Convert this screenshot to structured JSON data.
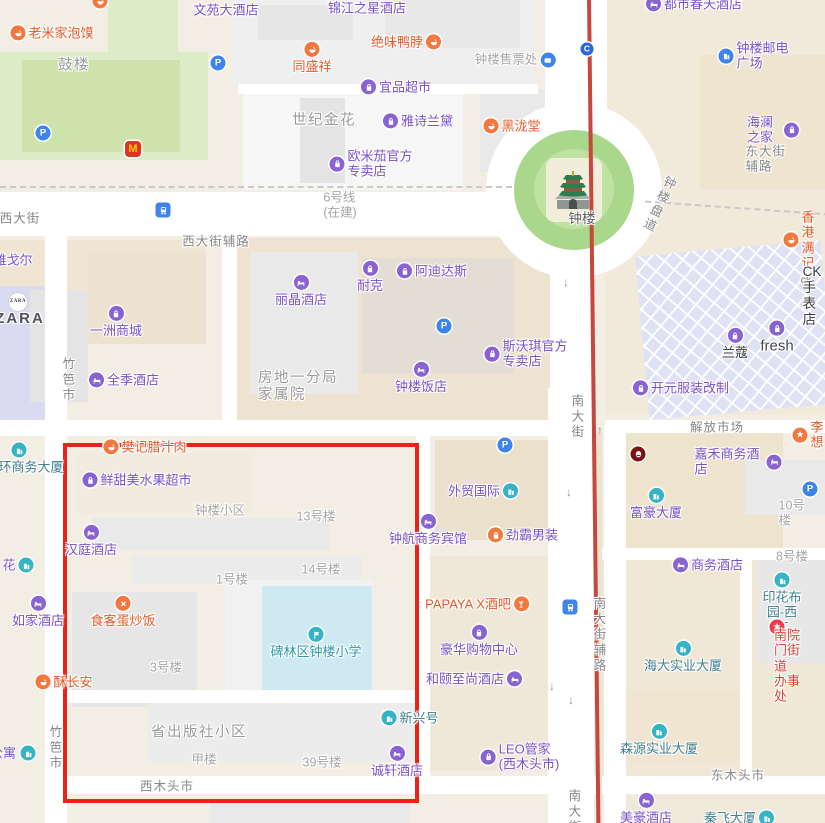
{
  "map": {
    "colors": {
      "poi_purple": "#7a52c8",
      "poi_orange": "#e25a28",
      "building_teal": "#41808f",
      "street_gray": "#878787",
      "block_gray": "#a6a6a6",
      "metro_line_red": "#c7463e",
      "highlight_red": "#e8231a",
      "parking_blue": "#3f84ee",
      "park_green": "#a9d88d"
    },
    "icons": {
      "parking": "P",
      "line_badge": "C",
      "mcdonalds": "M",
      "star": "★"
    },
    "pois": [
      {
        "l": "文苑大酒店",
        "x": 226,
        "y": 10,
        "k": "purple"
      },
      {
        "l": "",
        "x": 100,
        "y": 1,
        "k": "orange",
        "i": "food",
        "c": "orange"
      },
      {
        "l": "锦江之星酒店",
        "x": 367,
        "y": 8,
        "k": "purple"
      },
      {
        "l": "老米家泡馍",
        "x": 52,
        "y": 33,
        "k": "orange",
        "i": "food",
        "c": "orange"
      },
      {
        "l": "鼓楼",
        "x": 74,
        "y": 66,
        "k": "biggray"
      },
      {
        "l": "绝味鸭脖",
        "x": 406,
        "y": 42,
        "k": "orange",
        "i": "food",
        "c": "orange",
        "p": "right"
      },
      {
        "l": "同盛祥",
        "x": 312,
        "y": 58,
        "k": "orange",
        "i": "food",
        "c": "orange",
        "p": "above"
      },
      {
        "l": "钟楼售票处",
        "x": 515,
        "y": 60,
        "k": "gray",
        "i": "ticket",
        "c": "blue",
        "p": "right"
      },
      {
        "l": "都市春天酒店",
        "x": 694,
        "y": 4,
        "k": "purple",
        "i": "hotel",
        "c": "purple"
      },
      {
        "l": "",
        "x": 587,
        "y": 49,
        "k": "purple",
        "i": "c",
        "c": "cblue",
        "n": "metro-line-badge"
      },
      {
        "l": "钟楼邮电广场",
        "x": 754,
        "y": 56,
        "k": "purple",
        "i": "building",
        "c": "blue"
      },
      {
        "l": "",
        "x": 218,
        "y": 63,
        "k": "purple",
        "i": "p",
        "c": "blue",
        "n": "parking-icon"
      },
      {
        "l": "海澜之家",
        "x": 773,
        "y": 130,
        "k": "purple",
        "i": "bag",
        "c": "purple",
        "p": "right"
      },
      {
        "l": "宜品超市",
        "x": 396,
        "y": 87,
        "k": "purple",
        "i": "bag",
        "c": "purple"
      },
      {
        "l": "世纪金花",
        "x": 324,
        "y": 121,
        "k": "biggray"
      },
      {
        "l": "雅诗兰黛",
        "x": 418,
        "y": 121,
        "k": "purple",
        "i": "bag",
        "c": "purple"
      },
      {
        "l": "黑泷堂",
        "x": 512,
        "y": 126,
        "k": "orange",
        "i": "food",
        "c": "orange"
      },
      {
        "l": "东大街辅路",
        "x": 772,
        "y": 159,
        "k": "street"
      },
      {
        "l": "",
        "x": 43,
        "y": 133,
        "k": "purple",
        "i": "p",
        "c": "blue",
        "n": "parking-icon"
      },
      {
        "l": "",
        "x": 133,
        "y": 149,
        "k": "orange",
        "i": "m",
        "c": "mcd",
        "n": "mcdonalds-icon"
      },
      {
        "l": "欧米茄官方\n专卖店",
        "x": 371,
        "y": 164,
        "k": "purple",
        "i": "bag",
        "c": "purple"
      },
      {
        "l": "",
        "x": 573,
        "y": 190,
        "k": "purple",
        "i": "pagoda",
        "c": "none",
        "n": "bell-tower-icon"
      },
      {
        "l": "钟楼",
        "x": 582,
        "y": 219,
        "k": "tower"
      },
      {
        "l": "钟楼盘道",
        "x": 658,
        "y": 204,
        "k": "street",
        "v": true,
        "r": 25
      },
      {
        "l": "东大街",
        "x": 841,
        "y": 181,
        "k": "street"
      },
      {
        "l": "6号线\n(在建)",
        "x": 340,
        "y": 205,
        "k": "gray"
      },
      {
        "l": "西大街",
        "x": 20,
        "y": 219,
        "k": "street"
      },
      {
        "l": "",
        "x": 163,
        "y": 210,
        "k": "purple",
        "i": "train",
        "c": "metro",
        "n": "metro-station-icon"
      },
      {
        "l": "香港满记",
        "x": 799,
        "y": 240,
        "k": "orange",
        "i": "food",
        "c": "orange"
      },
      {
        "l": "西大街辅路",
        "x": 216,
        "y": 242,
        "k": "street"
      },
      {
        "l": "雅戈尔",
        "x": 13,
        "y": 260,
        "k": "purple"
      },
      {
        "l": "丽晶酒店",
        "x": 301,
        "y": 291,
        "k": "purple",
        "i": "hotel",
        "c": "purple",
        "p": "above"
      },
      {
        "l": "耐克",
        "x": 370,
        "y": 277,
        "k": "purple",
        "i": "bag",
        "c": "purple",
        "p": "above"
      },
      {
        "l": "阿迪达斯",
        "x": 432,
        "y": 271,
        "k": "purple",
        "i": "bag",
        "c": "purple"
      },
      {
        "l": "ck",
        "x": 806,
        "y": 280,
        "k": "cksm"
      },
      {
        "l": "",
        "x": 18,
        "y": 302,
        "k": "purple",
        "i": "zara",
        "c": "zara",
        "n": "zara-logo"
      },
      {
        "l": "ZARA",
        "x": 20,
        "y": 319,
        "k": "zara"
      },
      {
        "l": "一洲商城",
        "x": 116,
        "y": 322,
        "k": "purple",
        "i": "bag",
        "c": "purple",
        "p": "above"
      },
      {
        "l": "CK手表店",
        "x": 812,
        "y": 296,
        "k": "ck"
      },
      {
        "l": "",
        "x": 444,
        "y": 326,
        "k": "purple",
        "i": "p",
        "c": "blue",
        "n": "parking-icon"
      },
      {
        "l": "兰蔻",
        "x": 735,
        "y": 344,
        "k": "dark",
        "i": "bag",
        "c": "purple",
        "p": "above"
      },
      {
        "l": "fresh",
        "x": 777,
        "y": 338,
        "k": "fresh",
        "i": "bag",
        "c": "purple",
        "p": "above"
      },
      {
        "l": "斯沃琪官方\n专卖店",
        "x": 526,
        "y": 354,
        "k": "purple",
        "i": "bag",
        "c": "purple"
      },
      {
        "l": "竹笆市",
        "x": 67,
        "y": 380,
        "k": "street",
        "v": true
      },
      {
        "l": "全季酒店",
        "x": 124,
        "y": 380,
        "k": "purple",
        "i": "hotel",
        "c": "purple"
      },
      {
        "l": "钟楼饭店",
        "x": 421,
        "y": 378,
        "k": "purple",
        "i": "hotel",
        "c": "purple",
        "p": "above"
      },
      {
        "l": "房地一分局\n家属院",
        "x": 298,
        "y": 387,
        "k": "biggray"
      },
      {
        "l": "开元服装改制",
        "x": 681,
        "y": 388,
        "k": "purple",
        "i": "bag",
        "c": "purple"
      },
      {
        "l": "南大街",
        "x": 576,
        "y": 417,
        "k": "street",
        "v": true
      },
      {
        "l": "中大国际",
        "x": 843,
        "y": 371,
        "k": "purple"
      },
      {
        "l": "解放市场",
        "x": 717,
        "y": 428,
        "k": "street"
      },
      {
        "l": "李想",
        "x": 808,
        "y": 435,
        "k": "orange",
        "i": "star",
        "c": "orange"
      },
      {
        "l": "",
        "x": 19,
        "y": 450,
        "k": "teal",
        "i": "building",
        "c": "teal",
        "n": "office-building-icon"
      },
      {
        "l": "环商务大厦",
        "x": 31,
        "y": 467,
        "k": "teal"
      },
      {
        "l": "樊记腊汁肉",
        "x": 145,
        "y": 447,
        "k": "orange",
        "i": "food",
        "c": "orange"
      },
      {
        "l": "",
        "x": 638,
        "y": 454,
        "k": "red",
        "i": "kfc",
        "c": "kfc",
        "n": "kfc-icon"
      },
      {
        "l": "嘉禾商务酒店",
        "x": 738,
        "y": 462,
        "k": "purple",
        "i": "hotel",
        "c": "purple",
        "p": "right"
      },
      {
        "l": "鲜甜美水果超市",
        "x": 137,
        "y": 480,
        "k": "purple",
        "i": "bag",
        "c": "purple"
      },
      {
        "l": "外贸国际",
        "x": 483,
        "y": 491,
        "k": "purple",
        "i": "building",
        "c": "teal",
        "p": "right"
      },
      {
        "l": "",
        "x": 505,
        "y": 445,
        "k": "purple",
        "i": "p",
        "c": "blue",
        "n": "parking-icon"
      },
      {
        "l": "富豪大厦",
        "x": 656,
        "y": 504,
        "k": "purple",
        "i": "building",
        "c": "teal",
        "p": "above"
      },
      {
        "l": "",
        "x": 810,
        "y": 489,
        "k": "purple",
        "i": "p",
        "c": "blue",
        "n": "parking-icon"
      },
      {
        "l": "10号楼",
        "x": 794,
        "y": 513,
        "k": "gray"
      },
      {
        "l": "钟楼小区",
        "x": 220,
        "y": 511,
        "k": "gray"
      },
      {
        "l": "13号楼",
        "x": 316,
        "y": 517,
        "k": "gray"
      },
      {
        "l": "钟航商务宾馆",
        "x": 428,
        "y": 530,
        "k": "purple",
        "i": "hotel",
        "c": "purple",
        "p": "above"
      },
      {
        "l": "劲霸男装",
        "x": 523,
        "y": 535,
        "k": "purple",
        "i": "bag",
        "c": "orange"
      },
      {
        "l": "商务酒店",
        "x": 708,
        "y": 565,
        "k": "purple",
        "i": "hotel",
        "c": "purple"
      },
      {
        "l": "8号楼",
        "x": 792,
        "y": 557,
        "k": "gray"
      },
      {
        "l": "汉庭酒店",
        "x": 91,
        "y": 541,
        "k": "purple",
        "i": "hotel",
        "c": "purple",
        "p": "above"
      },
      {
        "l": "花",
        "x": 9,
        "y": 565,
        "k": "purple"
      },
      {
        "l": "",
        "x": 26,
        "y": 565,
        "k": "teal",
        "i": "building",
        "c": "teal",
        "n": "office-building-icon"
      },
      {
        "l": "1号楼",
        "x": 232,
        "y": 580,
        "k": "gray"
      },
      {
        "l": "14号楼",
        "x": 321,
        "y": 570,
        "k": "gray"
      },
      {
        "l": "如家酒店",
        "x": 38,
        "y": 612,
        "k": "purple",
        "i": "hotel",
        "c": "purple",
        "p": "above"
      },
      {
        "l": "食客蛋炒饭",
        "x": 123,
        "y": 612,
        "k": "orange",
        "i": "cross",
        "c": "orange",
        "p": "above"
      },
      {
        "l": "PAPAYA X酒吧",
        "x": 477,
        "y": 604,
        "k": "orange",
        "i": "cocktail",
        "c": "orange",
        "p": "right"
      },
      {
        "l": "",
        "x": 570,
        "y": 607,
        "k": "purple",
        "i": "train",
        "c": "metro",
        "n": "metro-station-icon"
      },
      {
        "l": "南大街辅路",
        "x": 598,
        "y": 635,
        "k": "street",
        "v": true
      },
      {
        "l": "印花布园-西区",
        "x": 782,
        "y": 604,
        "k": "teal",
        "i": "building",
        "c": "teal",
        "p": "above"
      },
      {
        "l": "豪华购物中心",
        "x": 479,
        "y": 641,
        "k": "purple",
        "i": "bag",
        "c": "purple",
        "p": "above"
      },
      {
        "l": "碑林区钟楼小学",
        "x": 316,
        "y": 643,
        "k": "school",
        "i": "school",
        "c": "teal",
        "p": "above"
      },
      {
        "l": "",
        "x": 777,
        "y": 627,
        "k": "red",
        "i": "star",
        "c": "red",
        "n": "government-office-icon"
      },
      {
        "l": "南院门街道\n办事处",
        "x": 791,
        "y": 666,
        "k": "red"
      },
      {
        "l": "和颐至尚酒店",
        "x": 474,
        "y": 679,
        "k": "purple",
        "i": "hotel",
        "c": "purple",
        "p": "right"
      },
      {
        "l": "海大实业大厦",
        "x": 683,
        "y": 657,
        "k": "teal",
        "i": "building",
        "c": "teal",
        "p": "above"
      },
      {
        "l": "酥长安",
        "x": 64,
        "y": 682,
        "k": "orange",
        "i": "food",
        "c": "orange"
      },
      {
        "l": "3号楼",
        "x": 166,
        "y": 668,
        "k": "gray"
      },
      {
        "l": "新兴号",
        "x": 410,
        "y": 718,
        "k": "teal",
        "i": "building",
        "c": "teal"
      },
      {
        "l": "省出版社小区",
        "x": 199,
        "y": 733,
        "k": "biggray"
      },
      {
        "l": "竹笆市",
        "x": 54,
        "y": 748,
        "k": "street",
        "v": true
      },
      {
        "l": "公寓",
        "x": 3,
        "y": 753,
        "k": "purple"
      },
      {
        "l": "",
        "x": 28,
        "y": 753,
        "k": "teal",
        "i": "building",
        "c": "teal",
        "n": "office-building-icon"
      },
      {
        "l": "LEO管家\n(西木头市)",
        "x": 520,
        "y": 757,
        "k": "purple",
        "i": "bag",
        "c": "purple"
      },
      {
        "l": "森源实业大厦",
        "x": 659,
        "y": 740,
        "k": "teal",
        "i": "building",
        "c": "teal",
        "p": "above"
      },
      {
        "l": "甲楼",
        "x": 204,
        "y": 760,
        "k": "gray"
      },
      {
        "l": "39号楼",
        "x": 322,
        "y": 763,
        "k": "gray"
      },
      {
        "l": "诚轩酒店",
        "x": 397,
        "y": 762,
        "k": "purple",
        "i": "hotel",
        "c": "purple",
        "p": "above"
      },
      {
        "l": "西木头市",
        "x": 167,
        "y": 787,
        "k": "street"
      },
      {
        "l": "东木头市",
        "x": 738,
        "y": 776,
        "k": "street"
      },
      {
        "l": "美豪酒店",
        "x": 646,
        "y": 809,
        "k": "purple",
        "i": "hotel",
        "c": "purple",
        "p": "above"
      },
      {
        "l": "秦飞大厦",
        "x": 739,
        "y": 818,
        "k": "teal",
        "i": "building",
        "c": "teal",
        "p": "right"
      },
      {
        "l": "南大街",
        "x": 573,
        "y": 812,
        "k": "street",
        "v": true
      },
      {
        "l": "↑",
        "x": 600,
        "y": 430,
        "k": "arrow"
      },
      {
        "l": "↓",
        "x": 569,
        "y": 492,
        "k": "arrow"
      },
      {
        "l": "↓",
        "x": 566,
        "y": 282,
        "k": "arrow"
      },
      {
        "l": "↓",
        "x": 552,
        "y": 686,
        "k": "arrow"
      },
      {
        "l": "↓",
        "x": 571,
        "y": 700,
        "k": "arrow"
      }
    ]
  }
}
